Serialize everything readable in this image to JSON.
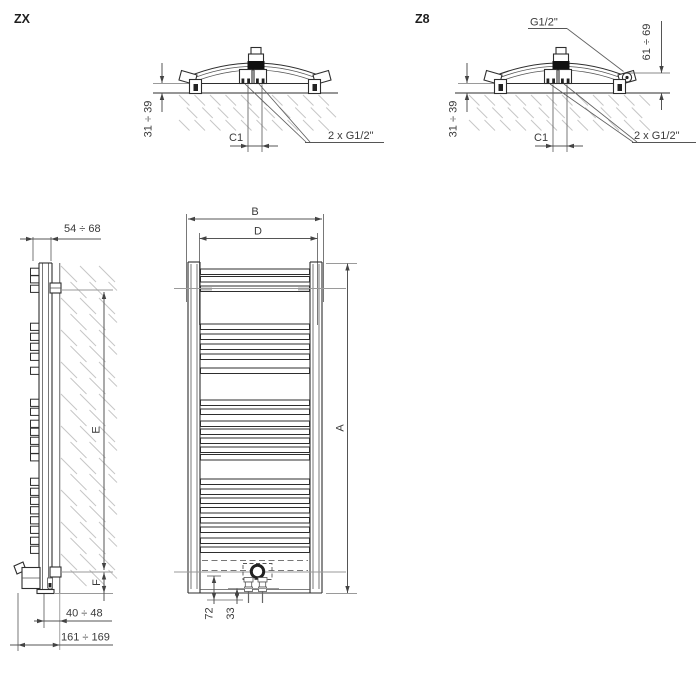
{
  "top_views": {
    "zx": {
      "label": "ZX",
      "wall_offset": "31 ÷ 39",
      "center_spacing": "C1",
      "connections": "2 x G1/2\""
    },
    "z8": {
      "label": "Z8",
      "side_connection": "G1/2\"",
      "side_offset": "61 ÷ 69",
      "wall_offset": "31 ÷ 39",
      "center_spacing": "C1",
      "connections": "2 x G1/2\""
    }
  },
  "side_view": {
    "depth": "54 ÷ 68",
    "upper_bracket": "E",
    "lower_bracket": "F",
    "wall_to_axis": "40 ÷ 48",
    "total_depth": "161 ÷ 169"
  },
  "front_view": {
    "width": "B",
    "pipe_spacing": "D",
    "height": "A",
    "valve_height": "72",
    "valve_offset": "33"
  },
  "geometry": {
    "rung_rows": [
      [
        269,
        276.5,
        286
      ],
      [
        324,
        334,
        344,
        354,
        368
      ],
      [
        400,
        409,
        421,
        429,
        438,
        447,
        454.5
      ],
      [
        479,
        489,
        498,
        507.5,
        517.5,
        527,
        538,
        547
      ]
    ],
    "rung_x": 200.5,
    "rung_w": 109,
    "rung_h": 5.5,
    "side_square_x": 30.5,
    "side_square_w": 8.5,
    "side_square_h": 7.2,
    "hatch_regions": [
      {
        "x0": 179,
        "y0": 95,
        "x1": 336,
        "y1": 131,
        "len": 10.5,
        "col": 15.5,
        "row": 12.5
      },
      {
        "x0": 469,
        "y0": 95,
        "x1": 651,
        "y1": 131,
        "len": 10.5,
        "col": 15.5,
        "row": 12.5
      },
      {
        "x0": 61,
        "y0": 266,
        "x1": 117,
        "y1": 590,
        "len": 16,
        "col": 19,
        "row": 16
      }
    ]
  },
  "colors": {
    "line": "#2e2e2e",
    "reference": "#9a9a9a",
    "hatch": "#c6c6c6",
    "text": "#3a3a3a"
  }
}
